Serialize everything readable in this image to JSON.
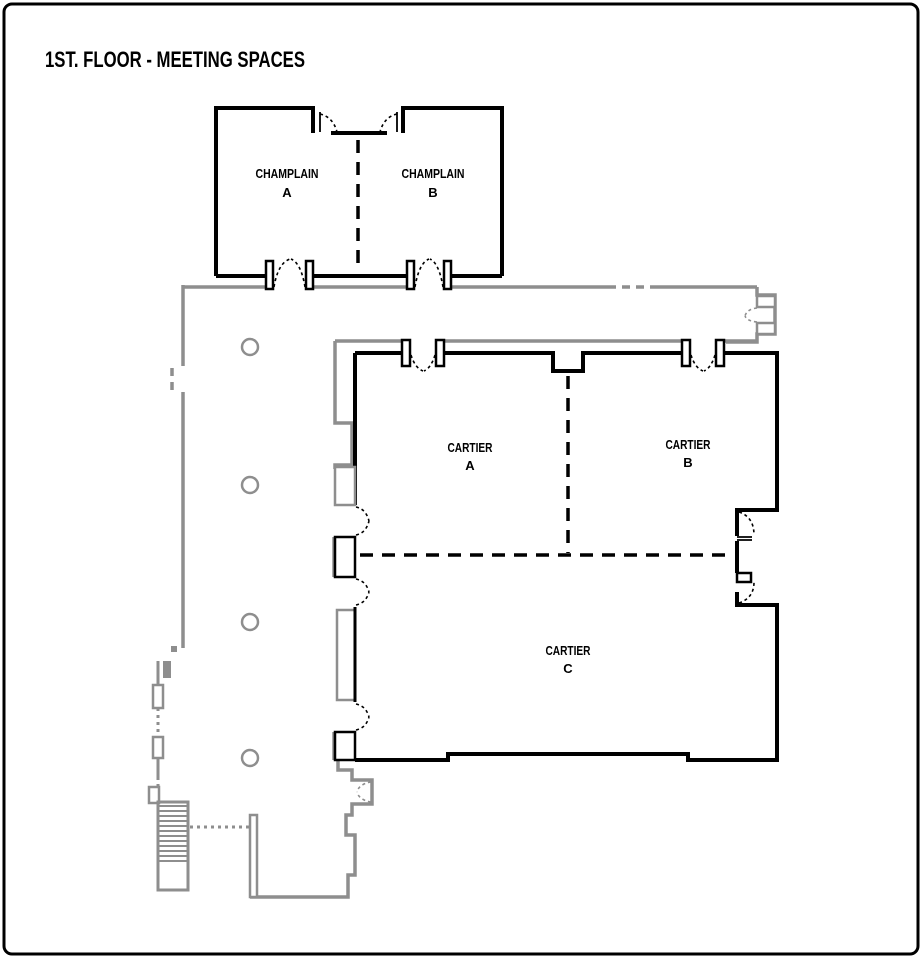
{
  "title": "1ST. FLOOR - MEETING SPACES",
  "rooms": [
    {
      "name": "CHAMPLAIN",
      "letter": "A"
    },
    {
      "name": "CHAMPLAIN",
      "letter": "B"
    },
    {
      "name": "CARTIER",
      "letter": "A"
    },
    {
      "name": "CARTIER",
      "letter": "B"
    },
    {
      "name": "CARTIER",
      "letter": "C"
    }
  ],
  "colors": {
    "wall": "#000000",
    "partition": "#8e8e8e",
    "background": "#ffffff"
  }
}
